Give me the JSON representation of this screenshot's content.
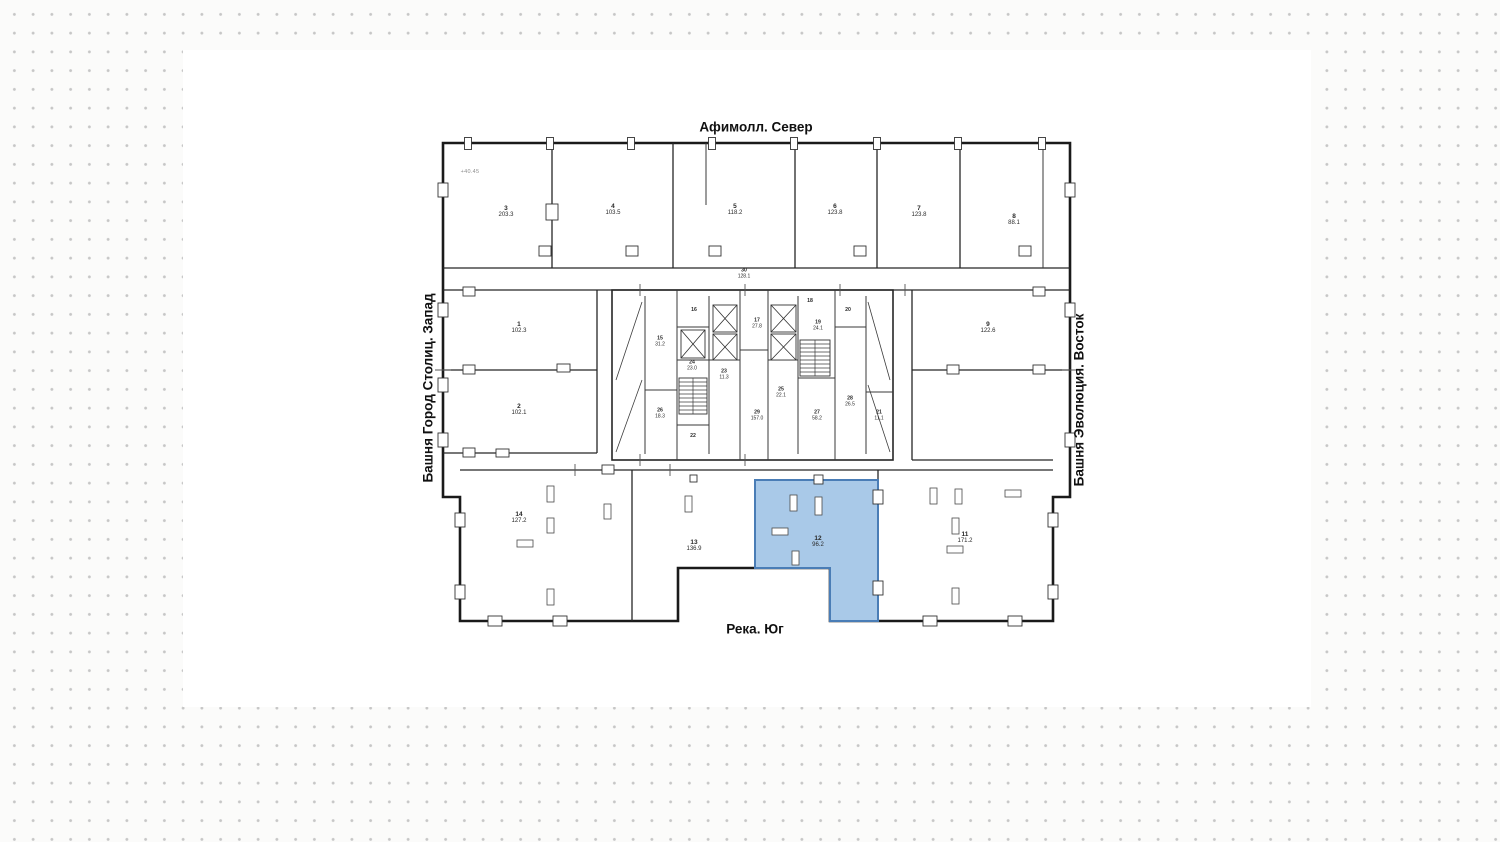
{
  "orientation": {
    "north": "Афимолл. Север",
    "west": "Башня Город Столиц. Запад",
    "east": "Башня Эволюция. Восток",
    "south": "Река. Юг"
  },
  "plan": {
    "elevation_note": "+40.45",
    "highlighted_unit": {
      "number": "12",
      "area": "96.2"
    },
    "colors": {
      "highlight_fill": "#a9c9e8",
      "highlight_stroke": "#4a7db6",
      "wall": "#1a1a1a",
      "background_dot": "#c6c6c6",
      "sheet": "#ffffff"
    },
    "rooms": [
      {
        "number": "3",
        "area": "203.3",
        "x": 506,
        "y": 212,
        "core": false
      },
      {
        "number": "4",
        "area": "103.5",
        "x": 613,
        "y": 210,
        "core": false
      },
      {
        "number": "5",
        "area": "118.2",
        "x": 735,
        "y": 210,
        "core": false
      },
      {
        "number": "6",
        "area": "123.8",
        "x": 835,
        "y": 210,
        "core": false
      },
      {
        "number": "7",
        "area": "123.8",
        "x": 919,
        "y": 212,
        "core": false
      },
      {
        "number": "8",
        "area": "88.1",
        "x": 1014,
        "y": 220,
        "core": false
      },
      {
        "number": "1",
        "area": "102.3",
        "x": 519,
        "y": 328,
        "core": false
      },
      {
        "number": "2",
        "area": "102.1",
        "x": 519,
        "y": 410,
        "core": false
      },
      {
        "number": "9",
        "area": "122.6",
        "x": 988,
        "y": 328,
        "core": false
      },
      {
        "number": "30",
        "area": "128.1",
        "x": 744,
        "y": 274,
        "core": true
      },
      {
        "number": "15",
        "area": "31.2",
        "x": 660,
        "y": 342,
        "core": true
      },
      {
        "number": "16",
        "area": "",
        "x": 694,
        "y": 311,
        "core": true
      },
      {
        "number": "24",
        "area": "23.0",
        "x": 692,
        "y": 366,
        "core": true
      },
      {
        "number": "23",
        "area": "11.3",
        "x": 724,
        "y": 375,
        "core": true
      },
      {
        "number": "26",
        "area": "18.3",
        "x": 660,
        "y": 414,
        "core": true
      },
      {
        "number": "22",
        "area": "",
        "x": 693,
        "y": 437,
        "core": true
      },
      {
        "number": "17",
        "area": "27.8",
        "x": 757,
        "y": 324,
        "core": true
      },
      {
        "number": "29",
        "area": "157.0",
        "x": 757,
        "y": 416,
        "core": true
      },
      {
        "number": "18",
        "area": "",
        "x": 810,
        "y": 302,
        "core": true
      },
      {
        "number": "19",
        "area": "24.1",
        "x": 818,
        "y": 326,
        "core": true
      },
      {
        "number": "20",
        "area": "",
        "x": 848,
        "y": 311,
        "core": true
      },
      {
        "number": "25",
        "area": "22.1",
        "x": 781,
        "y": 393,
        "core": true
      },
      {
        "number": "27",
        "area": "58.2",
        "x": 817,
        "y": 416,
        "core": true
      },
      {
        "number": "28",
        "area": "26.5",
        "x": 850,
        "y": 402,
        "core": true
      },
      {
        "number": "21",
        "area": "11.1",
        "x": 879,
        "y": 416,
        "core": true
      },
      {
        "number": "14",
        "area": "127.2",
        "x": 519,
        "y": 518,
        "core": false
      },
      {
        "number": "13",
        "area": "136.9",
        "x": 694,
        "y": 546,
        "core": false
      },
      {
        "number": "12",
        "area": "96.2",
        "x": 818,
        "y": 542,
        "core": false,
        "highlighted": true
      },
      {
        "number": "11",
        "area": "171.2",
        "x": 965,
        "y": 538,
        "core": false
      }
    ]
  }
}
